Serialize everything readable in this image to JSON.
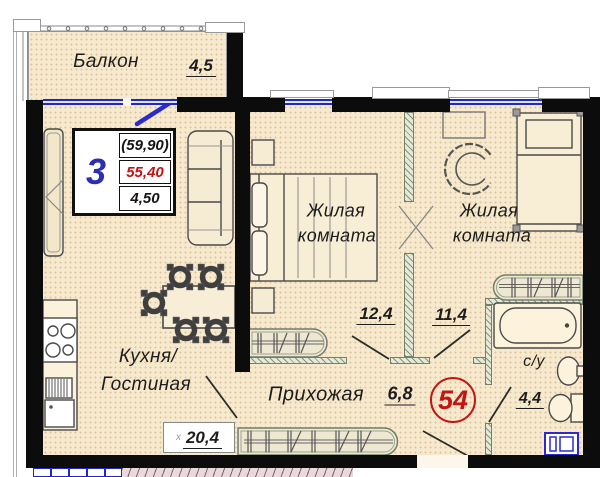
{
  "plan": {
    "apartment_badge": "54",
    "stamp": {
      "rooms_count": "3",
      "value_top": "(59,90)",
      "value_middle": "55,40",
      "value_bottom": "4,50"
    },
    "rooms": {
      "balcony": {
        "name": "Балкон",
        "area": "4,5"
      },
      "kitchen_living": {
        "name_line1": "Кухня/",
        "name_line2": "Гостиная",
        "area": "20,4",
        "area_mark": "х"
      },
      "bedroom_1": {
        "name_line1": "Жилая",
        "name_line2": "комната",
        "area": "12,4"
      },
      "bedroom_2": {
        "name_line1": "Жилая",
        "name_line2": "комната",
        "area": "11,4"
      },
      "hallway": {
        "name": "Прихожая",
        "area": "6,8"
      },
      "bathroom": {
        "name": "с/у",
        "area": "4,4"
      }
    },
    "colors": {
      "wall": "#0c0c0c",
      "floor": "#f7e9cd",
      "window": "#2228c0",
      "partition": "#e6e8d8",
      "accent_red": "#c41414",
      "stamp_blue": "#2e2eb0"
    }
  }
}
